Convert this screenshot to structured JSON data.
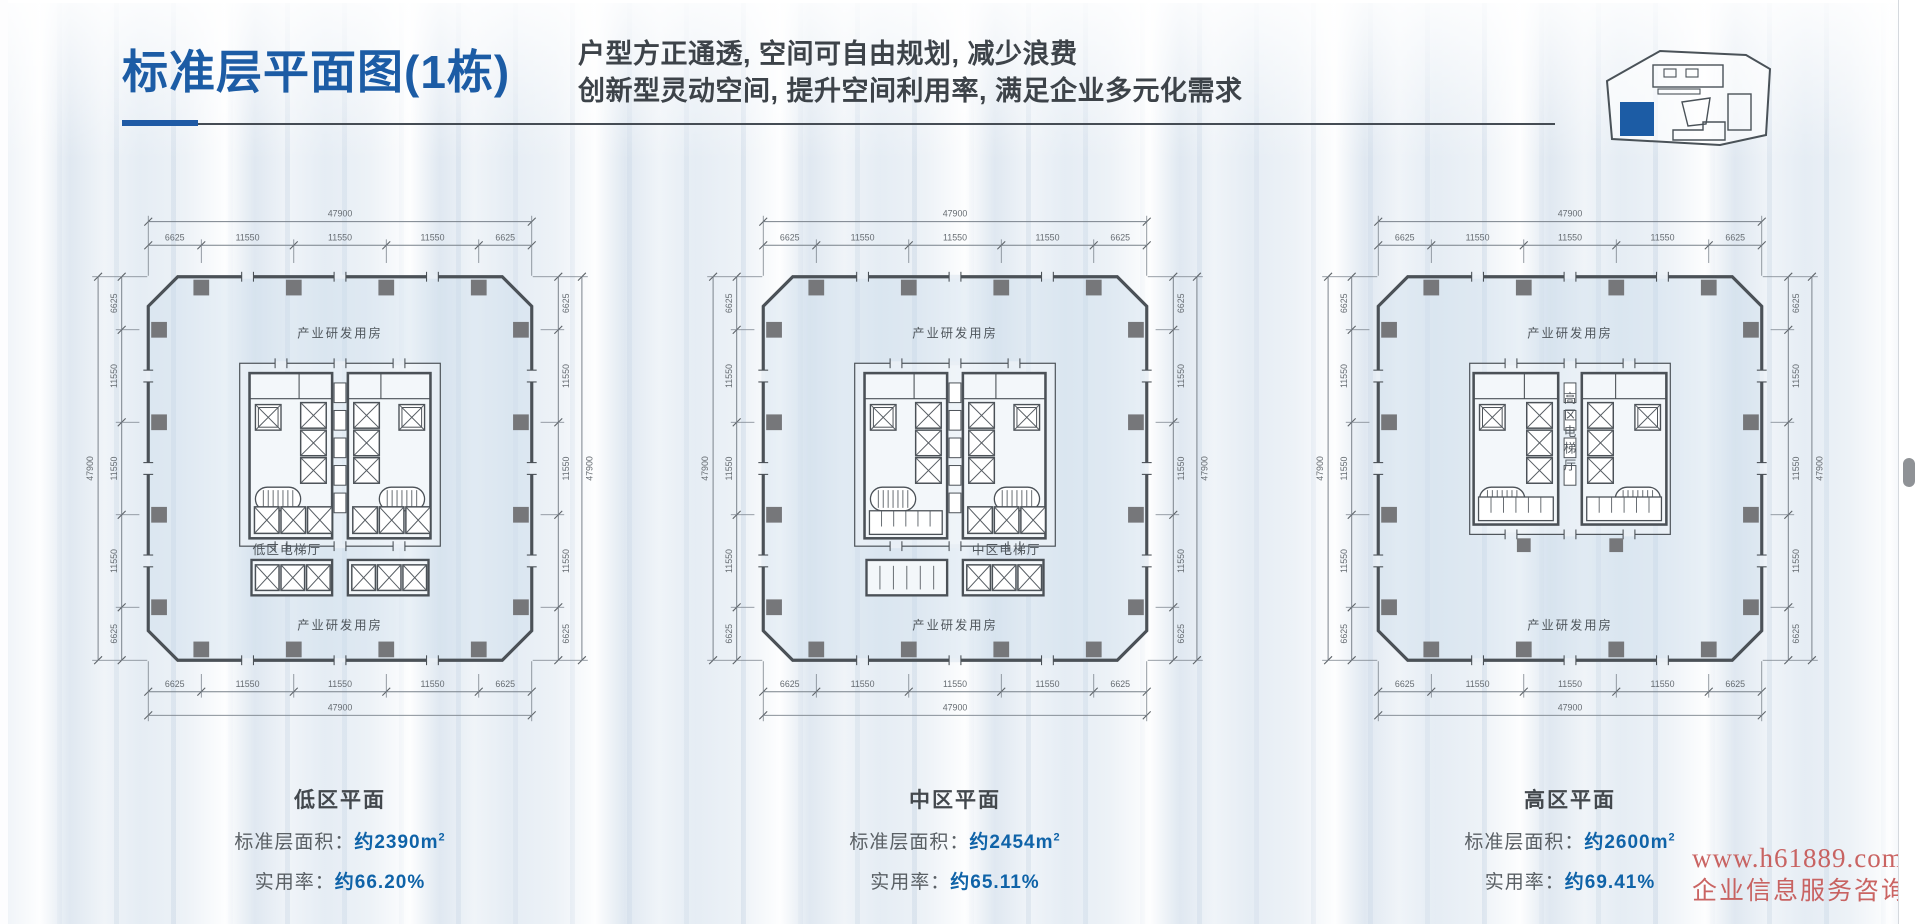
{
  "header": {
    "title": "标准层平面图(1栋)",
    "subtitle_line1": "户型方正通透, 空间可自由规划, 减少浪费",
    "subtitle_line2": "创新型灵动空间, 提升空间利用率, 满足企业多元化需求"
  },
  "dimensions": {
    "total": "47900",
    "chain": [
      "6625",
      "11550",
      "11550",
      "11550",
      "6625"
    ]
  },
  "plans": [
    {
      "id": "low",
      "name": "低区平面",
      "hall_label": "低区电梯厅",
      "room_label_top": "产业研发用房",
      "room_label_bottom": "产业研发用房",
      "area_label": "标准层面积：",
      "area_value": "约2390m",
      "area_sup": "2",
      "rate_label": "实用率：",
      "rate_value": "约66.20%"
    },
    {
      "id": "mid",
      "name": "中区平面",
      "hall_label": "中区电梯厅",
      "room_label_top": "产业研发用房",
      "room_label_bottom": "产业研发用房",
      "area_label": "标准层面积：",
      "area_value": "约2454m",
      "area_sup": "2",
      "rate_label": "实用率：",
      "rate_value": "约65.11%"
    },
    {
      "id": "high",
      "name": "高区平面",
      "hall_label": "高区电梯厅",
      "room_label_top": "产业研发用房",
      "room_label_bottom": "产业研发用房",
      "area_label": "标准层面积：",
      "area_value": "约2600m",
      "area_sup": "2",
      "rate_label": "实用率：",
      "rate_value": "约69.41%"
    }
  ],
  "watermark": {
    "line1": "www.h61889.com",
    "line2": "企业信息服务咨询"
  },
  "colors": {
    "accent_blue": "#1c5ca5",
    "value_blue": "#0f63a8",
    "heading_gray": "#3d4349",
    "line_dark": "#4b5157",
    "dim_gray": "#6a7076",
    "column_gray": "#76777a",
    "watermark_red": "#c4504e"
  }
}
